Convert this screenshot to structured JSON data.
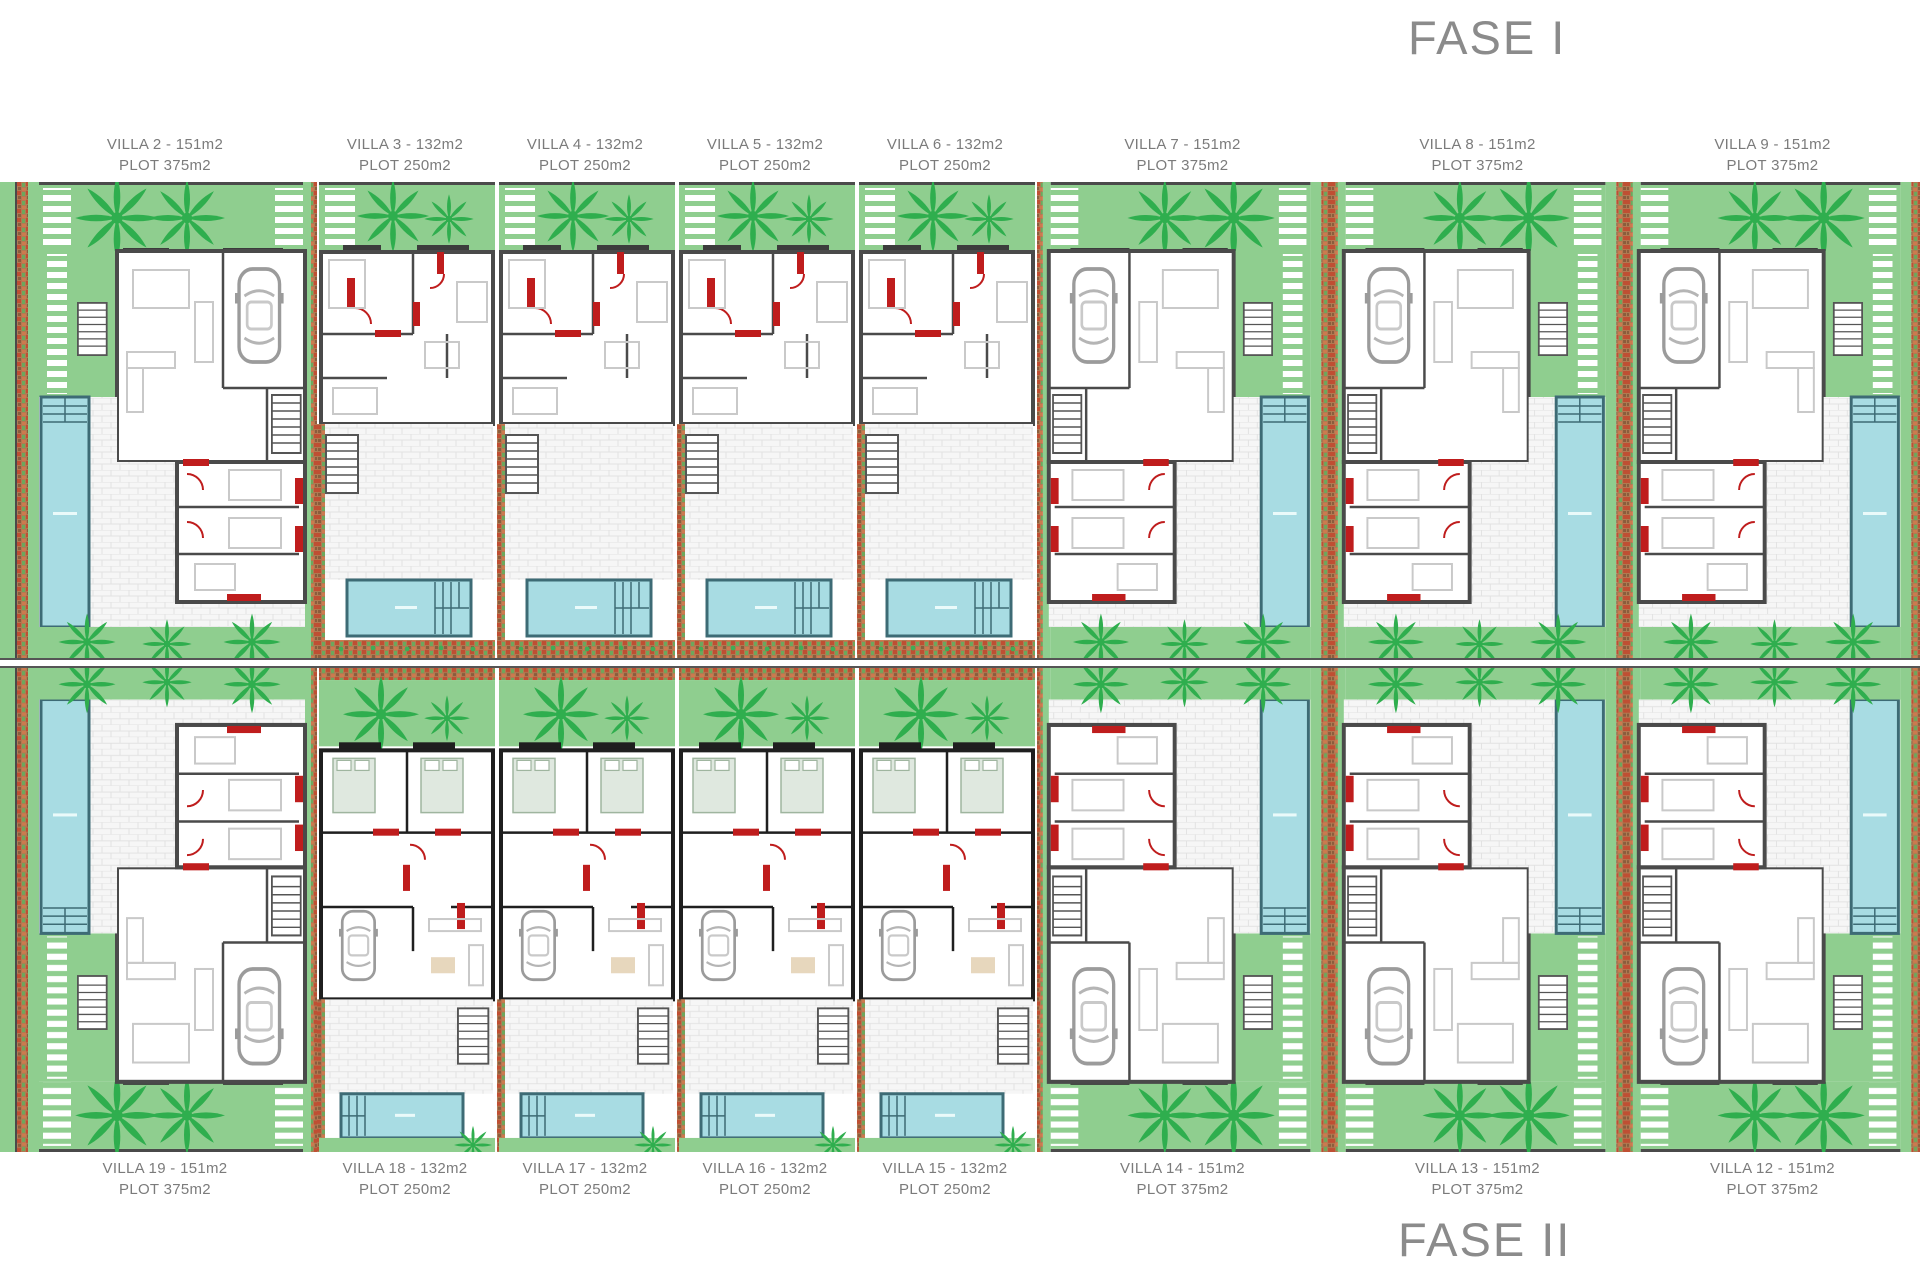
{
  "titles": {
    "fase_1": "FASE I",
    "fase_2": "FASE II"
  },
  "phase_1_villas": [
    {
      "name": "VILLA 2 - 151m2",
      "plot": "PLOT 375m2"
    },
    {
      "name": "VILLA 3 - 132m2",
      "plot": "PLOT 250m2"
    },
    {
      "name": "VILLA 4 - 132m2",
      "plot": "PLOT 250m2"
    },
    {
      "name": "VILLA 5 - 132m2",
      "plot": "PLOT 250m2"
    },
    {
      "name": "VILLA 6 - 132m2",
      "plot": "PLOT 250m2"
    },
    {
      "name": "VILLA 7 - 151m2",
      "plot": "PLOT 375m2"
    },
    {
      "name": "VILLA 8 - 151m2",
      "plot": "PLOT 375m2"
    },
    {
      "name": "VILLA 9 - 151m2",
      "plot": "PLOT 375m2"
    }
  ],
  "phase_2_villas": [
    {
      "name": "VILLA 19 - 151m2",
      "plot": "PLOT 375m2"
    },
    {
      "name": "VILLA 18 - 132m2",
      "plot": "PLOT 250m2"
    },
    {
      "name": "VILLA 17 - 132m2",
      "plot": "PLOT 250m2"
    },
    {
      "name": "VILLA 16 - 132m2",
      "plot": "PLOT 250m2"
    },
    {
      "name": "VILLA 15 - 132m2",
      "plot": "PLOT 250m2"
    },
    {
      "name": "VILLA 14 - 151m2",
      "plot": "PLOT 375m2"
    },
    {
      "name": "VILLA 13 - 151m2",
      "plot": "PLOT 375m2"
    },
    {
      "name": "VILLA 12 - 151m2",
      "plot": "PLOT 375m2"
    }
  ],
  "colors": {
    "garden_green": "#8FCE8F",
    "palm_green": "#2FAE4E",
    "pool_blue": "#A8DCE3",
    "pool_border": "#3D6B75",
    "wall_gray": "#4A4A4A",
    "wall_dark": "#1F1F1F",
    "accent_red": "#BF1D1D",
    "hedge_brown": "#B07A52",
    "paving_gray": "#E2E2E2",
    "label_text": "#7B7B7B",
    "title_text": "#8B8B8B"
  }
}
